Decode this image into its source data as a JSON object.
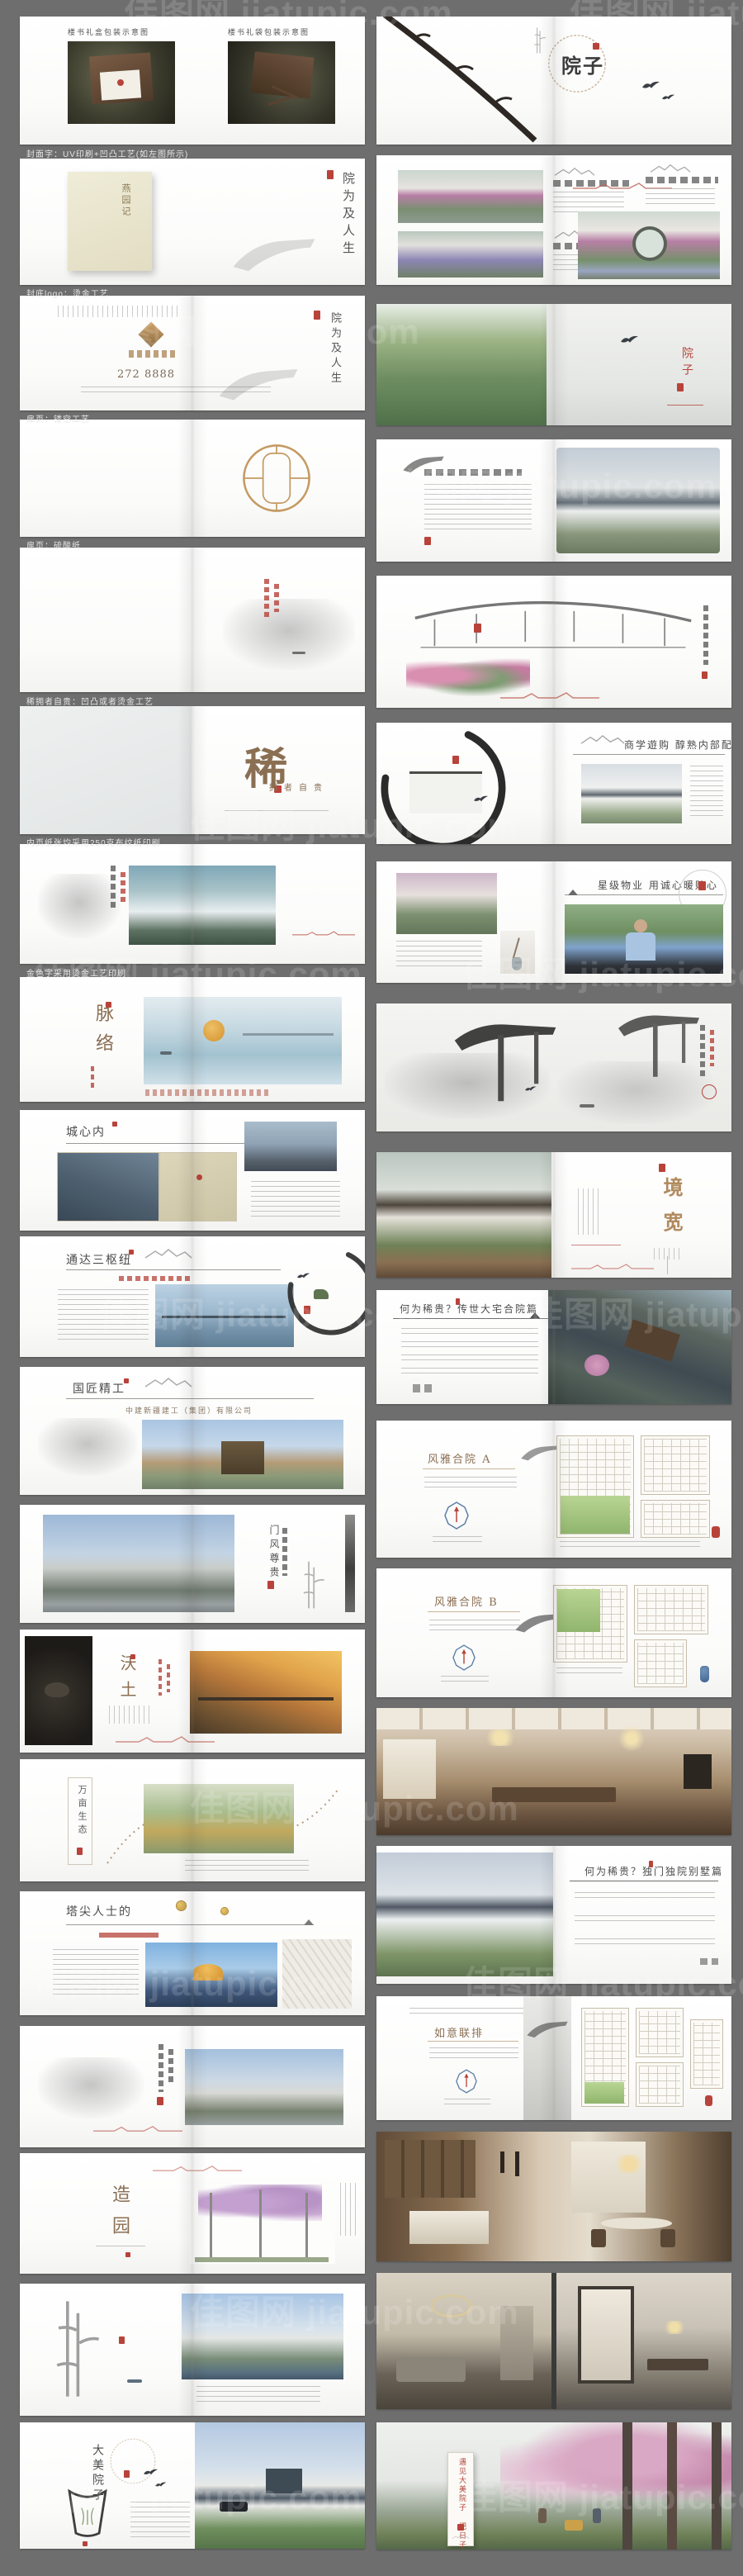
{
  "board": {
    "watermark": "佳图网 jiatupic.com",
    "colors": {
      "background": "#6e6e6e",
      "accent_red": "#b8433a",
      "gold": "#b08a5e",
      "ink": "#3f3f3f"
    }
  },
  "captions": {
    "c1": "封面字：UV印刷+凹凸工艺(如左图所示)",
    "c2": "封底logo：烫金工艺",
    "c3": "扉页：镂空工艺",
    "c4": "扉页：硫酸纸",
    "c5": "稀拥者自贵：凹凸或者烫金工艺",
    "c6": "内页纸张均采用250克布纹纸印刷",
    "c7": "金色字采用烫金工艺印刷"
  },
  "left": {
    "p1": {
      "box_caption": "楼书礼盒包装示意图",
      "bag_caption": "楼书礼袋包装示意图"
    },
    "p2": {
      "cover_title": "燕园记",
      "side_title": "院为及人生"
    },
    "p3": {
      "hotline": "272 8888",
      "side_title": "院为及人生"
    },
    "p6": {
      "big_char": "稀",
      "slogan": "拥者自贵"
    },
    "p8": {
      "title": "脉络"
    },
    "p9": {
      "title": "城心内"
    },
    "p10": {
      "title": "通达三枢纽"
    },
    "p11": {
      "title": "国匠精工",
      "subtitle": "中建新疆建工（集团）有限公司"
    },
    "p12": {
      "phrase": "门风尊贵"
    },
    "p13": {
      "title": "沃土"
    },
    "p14": {
      "title": "万亩生态"
    },
    "p15": {
      "title": "塔尖人士的"
    },
    "p17": {
      "title": "造园"
    },
    "p19": {
      "title": "大美院子"
    }
  },
  "right": {
    "p1": {
      "title": "院子"
    },
    "p3": {
      "side": "院子"
    },
    "p6": {
      "headline": "商学遊购 醇熟内部配套"
    },
    "p7": {
      "headline": "星级物业 用诚心暖贴心"
    },
    "p9": {
      "title": "境宽"
    },
    "p10": {
      "headline": "何为稀贵？传世大宅合院篇"
    },
    "p11": {
      "title": "风雅合院 A"
    },
    "p12": {
      "title": "风雅合院 B"
    },
    "p14": {
      "headline": "何为稀贵？独门独院别墅篇"
    },
    "p15": {
      "title": "如意联排"
    },
    "p18": {
      "plaque": "遇见大美院子 把日子过成诗"
    }
  }
}
